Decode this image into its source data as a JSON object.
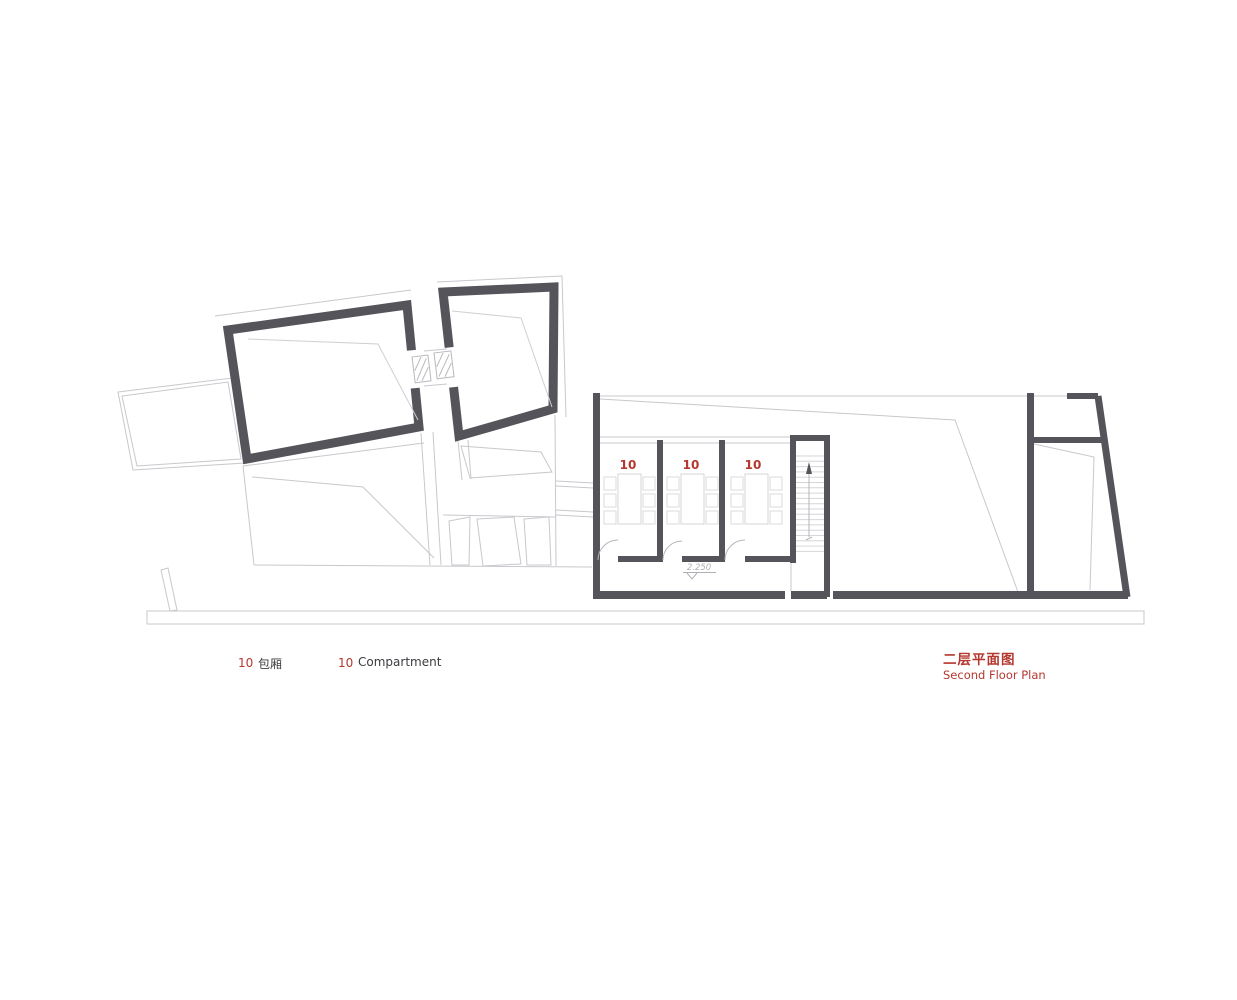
{
  "drawing": {
    "name": "floor-plan",
    "compartments": [
      {
        "label": "10"
      },
      {
        "label": "10"
      },
      {
        "label": "10"
      }
    ],
    "level_marker": "2.250"
  },
  "legend": {
    "key_number": "10",
    "zh_label": "包厢",
    "en_key_number": "10",
    "en_label": "Compartment"
  },
  "title": {
    "zh": "二层平面图",
    "en": "Second Floor Plan"
  },
  "colors": {
    "wall": "#54545a",
    "thin_line": "#c8c8cd",
    "furniture_line": "#dbdbde",
    "accent_red": "#b5372e",
    "door_arc": "#b5b5ba",
    "stair_tread": "#d6d6d9"
  }
}
